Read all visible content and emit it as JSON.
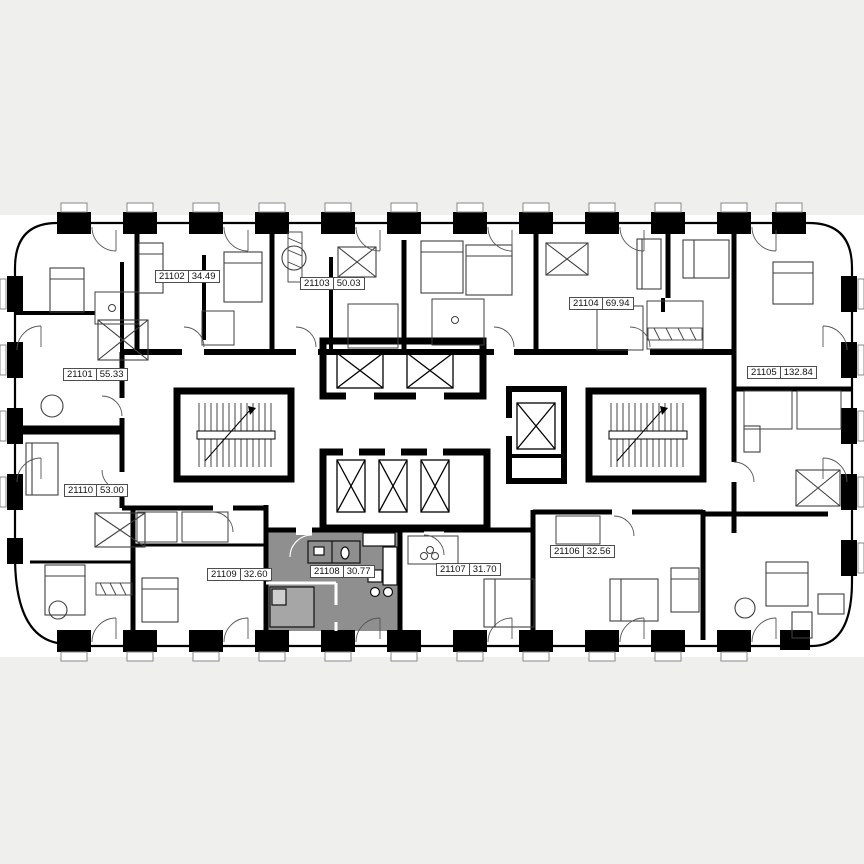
{
  "page": {
    "colors": {
      "background": "#efefed",
      "plan": "#ffffff",
      "walls": "#000000",
      "highlight": "#8f8f8f",
      "label_border": "#4d4d4d",
      "label_background": "#ffffff"
    }
  },
  "floor_plan": {
    "type": "residential-floor-plan",
    "units": [
      {
        "id": "21101",
        "area": "55.33",
        "highlighted": false
      },
      {
        "id": "21102",
        "area": "34.49",
        "highlighted": false
      },
      {
        "id": "21103",
        "area": "50.03",
        "highlighted": false
      },
      {
        "id": "21104",
        "area": "69.94",
        "highlighted": false
      },
      {
        "id": "21105",
        "area": "132.84",
        "highlighted": false
      },
      {
        "id": "21106",
        "area": "32.56",
        "highlighted": false
      },
      {
        "id": "21107",
        "area": "31.70",
        "highlighted": false
      },
      {
        "id": "21108",
        "area": "30.77",
        "highlighted": true
      },
      {
        "id": "21109",
        "area": "32.60",
        "highlighted": false
      },
      {
        "id": "21110",
        "area": "53.00",
        "highlighted": false
      }
    ],
    "selected_unit": {
      "id": "21108",
      "area": "30.77"
    }
  }
}
